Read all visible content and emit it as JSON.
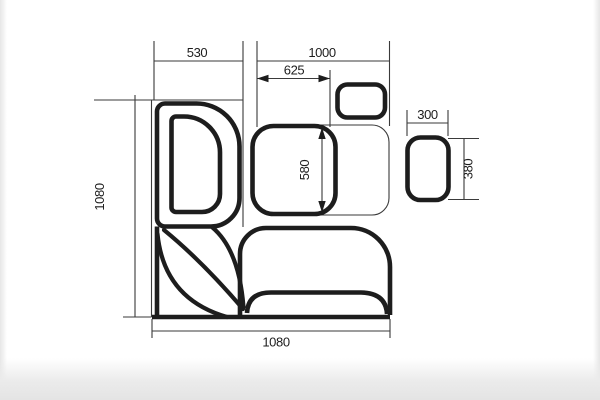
{
  "page": {
    "background": "#ffffff",
    "photo_edge_color": "#e9e9e9"
  },
  "drawing": {
    "type": "corner-bench-dining-set-top-view",
    "line_color": "#1d1d1d",
    "labels": {
      "left_seat_width": "530",
      "right_section_span": "1000",
      "table_span": "625",
      "table_depth": "580",
      "left_total_depth": "1080",
      "bottom_total_width": "1080",
      "stool_width": "300",
      "stool_depth": "380"
    }
  }
}
